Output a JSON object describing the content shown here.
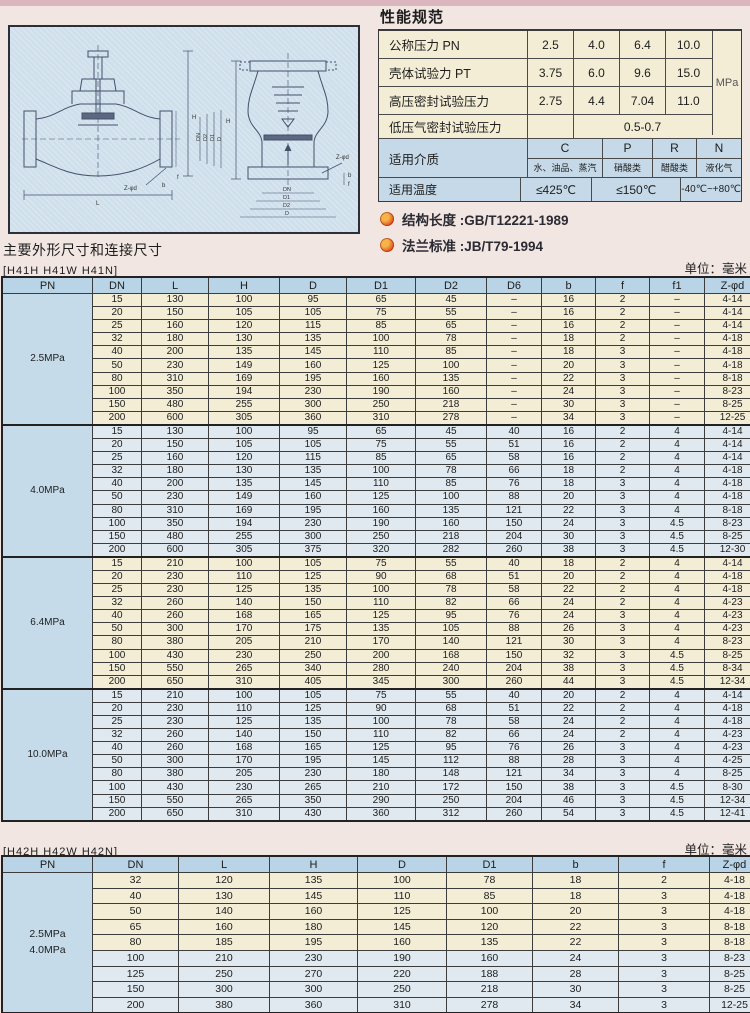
{
  "spec": {
    "title": "性能规范",
    "pressure_rows": [
      {
        "label": "公称压力 PN",
        "values": [
          "2.5",
          "4.0",
          "6.4",
          "10.0"
        ]
      },
      {
        "label": "壳体试验力 PT",
        "values": [
          "3.75",
          "6.0",
          "9.6",
          "15.0"
        ]
      },
      {
        "label": "高压密封试验压力",
        "values": [
          "2.75",
          "4.4",
          "7.04",
          "11.0"
        ]
      }
    ],
    "low_pressure_row": {
      "label": "低压气密封试验压力",
      "value": "0.5-0.7"
    },
    "unit": "MPa",
    "media_row": {
      "label": "适用介质",
      "codes": [
        "C",
        "P",
        "R",
        "N"
      ],
      "media": [
        "水、油品、蒸汽",
        "硝酸类",
        "醋酸类",
        "液化气"
      ]
    },
    "temp_row": {
      "label": "适用温度",
      "values": [
        "≤425℃",
        "≤150℃",
        "-40℃~+80℃"
      ]
    }
  },
  "notes": [
    {
      "text": "结构长度 :GB/T12221-1989"
    },
    {
      "text": "法兰标准 :JB/T79-1994"
    }
  ],
  "dims_title": "主要外形尺寸和连接尺寸",
  "table1": {
    "models": "[H41H  H41W  H41N]",
    "unit": "单位：毫米",
    "columns": [
      "PN",
      "DN",
      "L",
      "H",
      "D",
      "D1",
      "D2",
      "D6",
      "b",
      "f",
      "f1",
      "Z-φd"
    ],
    "groups": [
      {
        "pn": [
          "2.5MPa"
        ],
        "tint": "cream",
        "rows": [
          [
            "15",
            "130",
            "100",
            "95",
            "65",
            "45",
            "–",
            "16",
            "2",
            "–",
            "4-14"
          ],
          [
            "20",
            "150",
            "105",
            "105",
            "75",
            "55",
            "–",
            "16",
            "2",
            "–",
            "4-14"
          ],
          [
            "25",
            "160",
            "120",
            "115",
            "85",
            "65",
            "–",
            "16",
            "2",
            "–",
            "4-14"
          ],
          [
            "32",
            "180",
            "130",
            "135",
            "100",
            "78",
            "–",
            "18",
            "2",
            "–",
            "4-18"
          ],
          [
            "40",
            "200",
            "135",
            "145",
            "110",
            "85",
            "–",
            "18",
            "3",
            "–",
            "4-18"
          ],
          [
            "50",
            "230",
            "149",
            "160",
            "125",
            "100",
            "–",
            "20",
            "3",
            "–",
            "4-18"
          ],
          [
            "80",
            "310",
            "169",
            "195",
            "160",
            "135",
            "–",
            "22",
            "3",
            "–",
            "8-18"
          ],
          [
            "100",
            "350",
            "194",
            "230",
            "190",
            "160",
            "–",
            "24",
            "3",
            "–",
            "8-23"
          ],
          [
            "150",
            "480",
            "255",
            "300",
            "250",
            "218",
            "–",
            "30",
            "3",
            "–",
            "8-25"
          ],
          [
            "200",
            "600",
            "305",
            "360",
            "310",
            "278",
            "–",
            "34",
            "3",
            "–",
            "12-25"
          ]
        ]
      },
      {
        "pn": [
          "4.0MPa"
        ],
        "tint": "blue",
        "rows": [
          [
            "15",
            "130",
            "100",
            "95",
            "65",
            "45",
            "40",
            "16",
            "2",
            "4",
            "4-14"
          ],
          [
            "20",
            "150",
            "105",
            "105",
            "75",
            "55",
            "51",
            "16",
            "2",
            "4",
            "4-14"
          ],
          [
            "25",
            "160",
            "120",
            "115",
            "85",
            "65",
            "58",
            "16",
            "2",
            "4",
            "4-14"
          ],
          [
            "32",
            "180",
            "130",
            "135",
            "100",
            "78",
            "66",
            "18",
            "2",
            "4",
            "4-18"
          ],
          [
            "40",
            "200",
            "135",
            "145",
            "110",
            "85",
            "76",
            "18",
            "3",
            "4",
            "4-18"
          ],
          [
            "50",
            "230",
            "149",
            "160",
            "125",
            "100",
            "88",
            "20",
            "3",
            "4",
            "4-18"
          ],
          [
            "80",
            "310",
            "169",
            "195",
            "160",
            "135",
            "121",
            "22",
            "3",
            "4",
            "8-18"
          ],
          [
            "100",
            "350",
            "194",
            "230",
            "190",
            "160",
            "150",
            "24",
            "3",
            "4.5",
            "8-23"
          ],
          [
            "150",
            "480",
            "255",
            "300",
            "250",
            "218",
            "204",
            "30",
            "3",
            "4.5",
            "8-25"
          ],
          [
            "200",
            "600",
            "305",
            "375",
            "320",
            "282",
            "260",
            "38",
            "3",
            "4.5",
            "12-30"
          ]
        ]
      },
      {
        "pn": [
          "6.4MPa"
        ],
        "tint": "cream",
        "rows": [
          [
            "15",
            "210",
            "100",
            "105",
            "75",
            "55",
            "40",
            "18",
            "2",
            "4",
            "4-14"
          ],
          [
            "20",
            "230",
            "110",
            "125",
            "90",
            "68",
            "51",
            "20",
            "2",
            "4",
            "4-18"
          ],
          [
            "25",
            "230",
            "125",
            "135",
            "100",
            "78",
            "58",
            "22",
            "2",
            "4",
            "4-18"
          ],
          [
            "32",
            "260",
            "140",
            "150",
            "110",
            "82",
            "66",
            "24",
            "2",
            "4",
            "4-23"
          ],
          [
            "40",
            "260",
            "168",
            "165",
            "125",
            "95",
            "76",
            "24",
            "3",
            "4",
            "4-23"
          ],
          [
            "50",
            "300",
            "170",
            "175",
            "135",
            "105",
            "88",
            "26",
            "3",
            "4",
            "4-23"
          ],
          [
            "80",
            "380",
            "205",
            "210",
            "170",
            "140",
            "121",
            "30",
            "3",
            "4",
            "8-23"
          ],
          [
            "100",
            "430",
            "230",
            "250",
            "200",
            "168",
            "150",
            "32",
            "3",
            "4.5",
            "8-25"
          ],
          [
            "150",
            "550",
            "265",
            "340",
            "280",
            "240",
            "204",
            "38",
            "3",
            "4.5",
            "8-34"
          ],
          [
            "200",
            "650",
            "310",
            "405",
            "345",
            "300",
            "260",
            "44",
            "3",
            "4.5",
            "12-34"
          ]
        ]
      },
      {
        "pn": [
          "10.0MPa"
        ],
        "tint": "blue",
        "rows": [
          [
            "15",
            "210",
            "100",
            "105",
            "75",
            "55",
            "40",
            "20",
            "2",
            "4",
            "4-14"
          ],
          [
            "20",
            "230",
            "110",
            "125",
            "90",
            "68",
            "51",
            "22",
            "2",
            "4",
            "4-18"
          ],
          [
            "25",
            "230",
            "125",
            "135",
            "100",
            "78",
            "58",
            "24",
            "2",
            "4",
            "4-18"
          ],
          [
            "32",
            "260",
            "140",
            "150",
            "110",
            "82",
            "66",
            "24",
            "2",
            "4",
            "4-23"
          ],
          [
            "40",
            "260",
            "168",
            "165",
            "125",
            "95",
            "76",
            "26",
            "3",
            "4",
            "4-23"
          ],
          [
            "50",
            "300",
            "170",
            "195",
            "145",
            "112",
            "88",
            "28",
            "3",
            "4",
            "4-25"
          ],
          [
            "80",
            "380",
            "205",
            "230",
            "180",
            "148",
            "121",
            "34",
            "3",
            "4",
            "8-25"
          ],
          [
            "100",
            "430",
            "230",
            "265",
            "210",
            "172",
            "150",
            "38",
            "3",
            "4.5",
            "8-30"
          ],
          [
            "150",
            "550",
            "265",
            "350",
            "290",
            "250",
            "204",
            "46",
            "3",
            "4.5",
            "12-34"
          ],
          [
            "200",
            "650",
            "310",
            "430",
            "360",
            "312",
            "260",
            "54",
            "3",
            "4.5",
            "12-41"
          ]
        ]
      }
    ]
  },
  "table2": {
    "models": "[H42H  H42W  H42N]",
    "unit": "单位：毫米",
    "columns": [
      "PN",
      "DN",
      "L",
      "H",
      "D",
      "D1",
      "b",
      "f",
      "Z-φd"
    ],
    "groups": [
      {
        "pn": [
          "2.5MPa",
          "4.0MPa"
        ],
        "row_tints": [
          "cream",
          "cream",
          "cream",
          "cream",
          "cream",
          "blue",
          "blue",
          "blue",
          "blue"
        ],
        "rows": [
          [
            "32",
            "120",
            "135",
            "100",
            "78",
            "18",
            "2",
            "4-18"
          ],
          [
            "40",
            "130",
            "145",
            "110",
            "85",
            "18",
            "3",
            "4-18"
          ],
          [
            "50",
            "140",
            "160",
            "125",
            "100",
            "20",
            "3",
            "4-18"
          ],
          [
            "65",
            "160",
            "180",
            "145",
            "120",
            "22",
            "3",
            "8-18"
          ],
          [
            "80",
            "185",
            "195",
            "160",
            "135",
            "22",
            "3",
            "8-18"
          ],
          [
            "100",
            "210",
            "230",
            "190",
            "160",
            "24",
            "3",
            "8-23"
          ],
          [
            "125",
            "250",
            "270",
            "220",
            "188",
            "28",
            "3",
            "8-25"
          ],
          [
            "150",
            "300",
            "300",
            "250",
            "218",
            "30",
            "3",
            "8-25"
          ],
          [
            "200",
            "380",
            "360",
            "310",
            "278",
            "34",
            "3",
            "12-25"
          ]
        ]
      }
    ]
  },
  "drawing": {
    "left_labels": {
      "h": "H",
      "l": "L",
      "zphid": "Z-φd",
      "b": "b",
      "f": "f",
      "dn": "DN",
      "d2": "D2",
      "d1": "D1",
      "d": "D"
    },
    "right_labels": {
      "h": "H",
      "dn": "DN",
      "d1": "D1",
      "d2": "D2",
      "d": "D",
      "zphid": "Z-φd",
      "b": "b",
      "f": "f"
    }
  }
}
